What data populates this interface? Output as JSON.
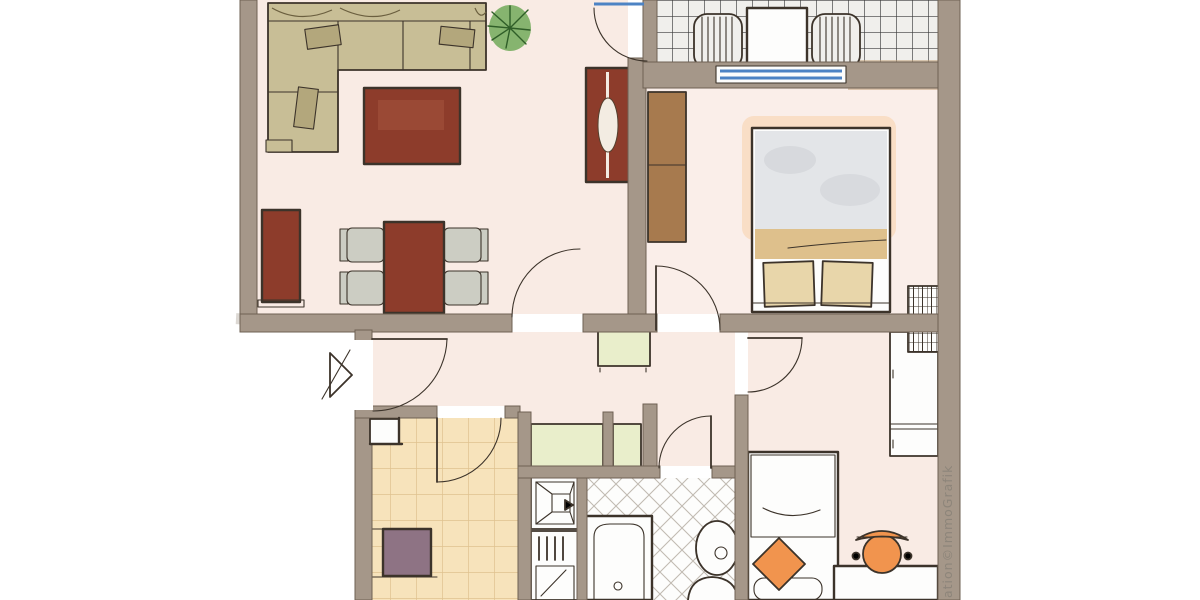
{
  "watermark": {
    "text": "ation©ImmoGrafik"
  },
  "palette": {
    "wall": "#a59789",
    "wallEdge": "#6e6053",
    "outline": "#3c332a",
    "floor": "#f9ebe4",
    "floorBedroom": "#faeee9",
    "sofa": "#c8be96",
    "sofaShade": "#b3a77c",
    "red": "#8d3c2b",
    "wood": "#a77a4e",
    "duvet": "#e3e5e8",
    "blanket": "#dec08c",
    "pillow": "#e8d6aa",
    "white": "#fdfdfc",
    "chairGray": "#cccdc3",
    "greenCounter": "#e9eecb",
    "plant": "#79ae62",
    "plantDark": "#2f5e28",
    "purple": "#8e7384",
    "orange": "#f1944e",
    "blue": "#4d83c4",
    "tile": "#f7e3bb",
    "tileLine": "#dfc18f",
    "balconyFloor": "#f0efec",
    "gridLine": "#3b3b3b",
    "bathLine": "#c1bbb2",
    "watermark": "#8d857a",
    "glow": "#f7c591",
    "wash": "#c3a37c"
  }
}
